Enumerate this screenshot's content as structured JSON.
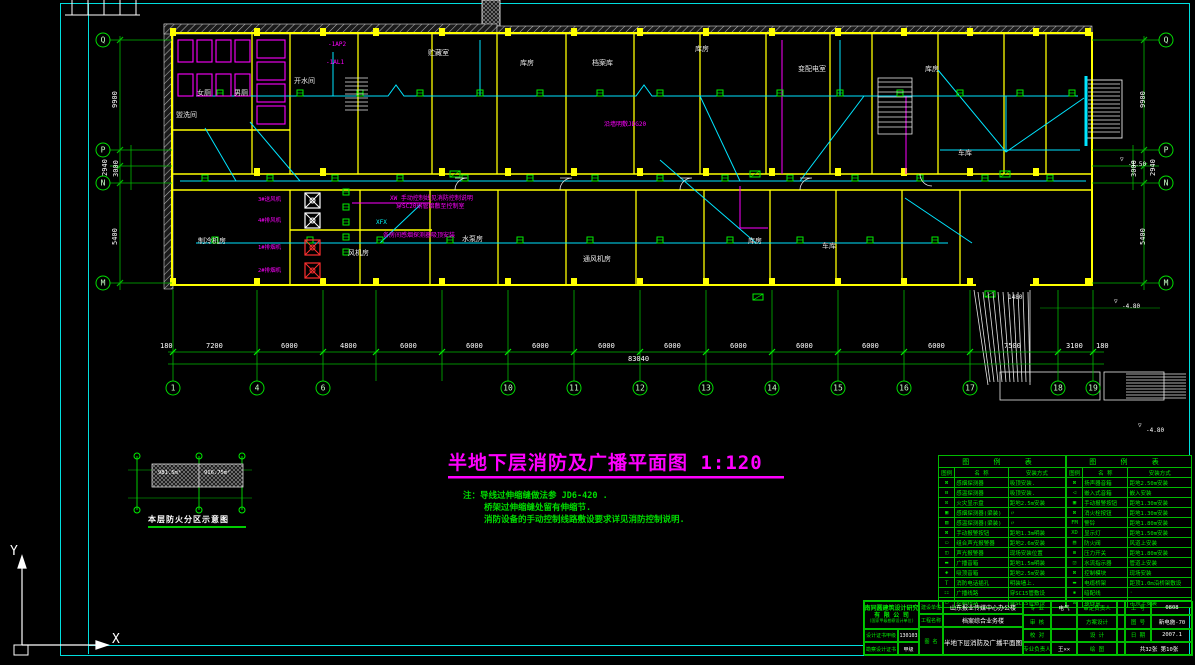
{
  "title": {
    "text": "半地下层消防及广播平面图 1:120"
  },
  "notes": {
    "prefix": "注：",
    "lines": [
      "导线过伸缩缝做法参 JD6-420 .",
      "桥架过伸缩缝处留有伸缩节.",
      "消防设备的手动控制线路敷设要求详见消防控制说明."
    ]
  },
  "compartment": {
    "caption": "本层防火分区示意图",
    "area_left": "981.5m²",
    "area_right": "916.75m²"
  },
  "ucs": {
    "x": "X",
    "y": "Y"
  },
  "grid": {
    "bottom": [
      {
        "n": "1",
        "x": 173
      },
      {
        "n": "4",
        "x": 257
      },
      {
        "n": "6",
        "x": 323
      },
      {
        "n": "10",
        "x": 508
      },
      {
        "n": "11",
        "x": 574
      },
      {
        "n": "12",
        "x": 640
      },
      {
        "n": "13",
        "x": 706
      },
      {
        "n": "14",
        "x": 772
      },
      {
        "n": "15",
        "x": 838
      },
      {
        "n": "16",
        "x": 904
      },
      {
        "n": "17",
        "x": 970
      },
      {
        "n": "18",
        "x": 1058
      },
      {
        "n": "19",
        "x": 1093
      }
    ],
    "left": [
      {
        "n": "Q",
        "y": 40
      },
      {
        "n": "P",
        "y": 150
      },
      {
        "n": "N",
        "y": 183
      },
      {
        "n": "M",
        "y": 283
      }
    ],
    "right": [
      {
        "n": "Q",
        "y": 40
      },
      {
        "n": "P",
        "y": 150
      },
      {
        "n": "N",
        "y": 183
      },
      {
        "n": "M",
        "y": 283
      }
    ]
  },
  "dims": {
    "h": [
      {
        "t": "180",
        "x": 160
      },
      {
        "t": "7200",
        "x": 206
      },
      {
        "t": "6000",
        "x": 281
      },
      {
        "t": "4800",
        "x": 340
      },
      {
        "t": "6000",
        "x": 400
      },
      {
        "t": "6000",
        "x": 466
      },
      {
        "t": "6000",
        "x": 532
      },
      {
        "t": "6000",
        "x": 598
      },
      {
        "t": "6000",
        "x": 664
      },
      {
        "t": "6000",
        "x": 730
      },
      {
        "t": "6000",
        "x": 796
      },
      {
        "t": "6000",
        "x": 862
      },
      {
        "t": "6000",
        "x": 928
      },
      {
        "t": "7500",
        "x": 1004
      },
      {
        "t": "3100",
        "x": 1066
      },
      {
        "t": "180",
        "x": 1096
      }
    ],
    "total": {
      "t": "83040",
      "x": 628
    },
    "v_left": [
      {
        "t": "9900",
        "x": 112,
        "y": 108
      },
      {
        "t": "2940",
        "x": 102,
        "y": 176
      },
      {
        "t": "3000",
        "x": 113,
        "y": 177
      },
      {
        "t": "5400",
        "x": 112,
        "y": 245
      }
    ],
    "v_right": [
      {
        "t": "9900",
        "x": 1140,
        "y": 108
      },
      {
        "t": "2940",
        "x": 1150,
        "y": 176
      },
      {
        "t": "3000",
        "x": 1131,
        "y": 177
      },
      {
        "t": "5400",
        "x": 1140,
        "y": 245
      }
    ]
  },
  "labels": {
    "rooms": [
      {
        "t": "女厕",
        "x": 197,
        "y": 90
      },
      {
        "t": "男厕",
        "x": 234,
        "y": 90
      },
      {
        "t": "开水间",
        "x": 294,
        "y": 78
      },
      {
        "t": "盥洗间",
        "x": 176,
        "y": 112
      },
      {
        "t": "贮藏室",
        "x": 428,
        "y": 50
      },
      {
        "t": "库房",
        "x": 520,
        "y": 60
      },
      {
        "t": "档案库",
        "x": 592,
        "y": 60
      },
      {
        "t": "库房",
        "x": 695,
        "y": 46
      },
      {
        "t": "变配电室",
        "x": 798,
        "y": 66
      },
      {
        "t": "库房",
        "x": 925,
        "y": 66
      },
      {
        "t": "车库",
        "x": 958,
        "y": 150
      },
      {
        "t": "制冷机房",
        "x": 198,
        "y": 238
      },
      {
        "t": "风机房",
        "x": 348,
        "y": 250
      },
      {
        "t": "水泵房",
        "x": 462,
        "y": 236
      },
      {
        "t": "通风机房",
        "x": 583,
        "y": 256
      },
      {
        "t": "库房",
        "x": 748,
        "y": 238
      },
      {
        "t": "车库",
        "x": 822,
        "y": 243
      }
    ],
    "magenta": [
      {
        "t": "-1AP2",
        "x": 328,
        "y": 42
      },
      {
        "t": "-1AL1",
        "x": 326,
        "y": 60
      },
      {
        "t": "XW 手动控制线见消防控制说明",
        "x": 390,
        "y": 196
      },
      {
        "t": "穿SC20钢管暗敷至控制室",
        "x": 396,
        "y": 204
      },
      {
        "t": "各房间感烟探测器吸顶安装",
        "x": 383,
        "y": 233
      },
      {
        "t": "沿墙明敷JDG20",
        "x": 604,
        "y": 122
      }
    ],
    "cyan": [
      {
        "t": "XFX",
        "x": 376,
        "y": 220
      }
    ],
    "white": [
      {
        "t": "▽",
        "x": 1120,
        "y": 157
      },
      {
        "t": "-1.50",
        "x": 1128,
        "y": 162
      },
      {
        "t": "▽",
        "x": 1114,
        "y": 299
      },
      {
        "t": "-4.80",
        "x": 1122,
        "y": 304
      },
      {
        "t": "▽",
        "x": 1138,
        "y": 423
      },
      {
        "t": "-4.80",
        "x": 1146,
        "y": 428
      },
      {
        "t": "1480",
        "x": 1008,
        "y": 295
      }
    ],
    "fans": [
      {
        "t": "3#送风机",
        "x": 258,
        "y": 198
      },
      {
        "t": "4#排风机",
        "x": 258,
        "y": 219
      },
      {
        "t": "1#排烟机",
        "x": 258,
        "y": 246
      },
      {
        "t": "2#排烟机",
        "x": 258,
        "y": 269
      }
    ]
  },
  "legend_left": {
    "title": "图 例 表",
    "headers": [
      "图例",
      "名 称",
      "安装方式"
    ],
    "rows": [
      {
        "sym": "⊠",
        "name": "感烟探测器",
        "inst": "吸顶安装."
      },
      {
        "sym": "⊟",
        "name": "感温探测器",
        "inst": "吸顶安装."
      },
      {
        "sym": "⊡",
        "name": "火灾显示盘",
        "inst": "距地2.5m安装"
      },
      {
        "sym": "▣",
        "name": "感烟探测器(梁装)",
        "inst": "〃"
      },
      {
        "sym": "▥",
        "name": "感温探测器(梁装)",
        "inst": "〃"
      },
      {
        "sym": "⊠",
        "name": "手动报警按钮",
        "inst": "距地1.3m明装"
      },
      {
        "sym": "▭",
        "name": "组合声光报警器",
        "inst": "距地2.6m安装"
      },
      {
        "sym": "◫",
        "name": "声光报警器",
        "inst": "现场安装位置"
      },
      {
        "sym": "▬",
        "name": "广播音箱",
        "inst": "距地1.5m明装"
      },
      {
        "sym": "◈",
        "name": "吸顶音箱",
        "inst": "距地2.5m安装"
      },
      {
        "sym": "Ｔ",
        "name": "消防电话插孔",
        "inst": "明装墙上."
      },
      {
        "sym": "⚏",
        "name": "广播线路",
        "inst": "穿SC15管敷设"
      },
      {
        "sym": "▭",
        "name": "控制线路",
        "inst": "穿SC15管敷设"
      }
    ]
  },
  "legend_right": {
    "title": "图 例 表",
    "headers": [
      "图例",
      "名 称",
      "安装方式"
    ],
    "rows": [
      {
        "sym": "⊠",
        "name": "扬声器音箱",
        "inst": "距地2.50m安装"
      },
      {
        "sym": "◁",
        "name": "嵌入式音箱",
        "inst": "嵌入安装"
      },
      {
        "sym": "▣",
        "name": "手动报警按钮",
        "inst": "距地1.30m安装"
      },
      {
        "sym": "⊠",
        "name": "消火栓按钮",
        "inst": "距地1.30m安装"
      },
      {
        "sym": "FM",
        "name": "警铃",
        "inst": "距地1.80m安装"
      },
      {
        "sym": "XD",
        "name": "显示灯",
        "inst": "距地1.50m安装"
      },
      {
        "sym": "▤",
        "name": "防火阀",
        "inst": "风道上安装"
      },
      {
        "sym": "⊞",
        "name": "压力开关",
        "inst": "距地1.80m安装"
      },
      {
        "sym": "◲",
        "name": "水流指示器",
        "inst": "管道上安装"
      },
      {
        "sym": "⊠",
        "name": "控制模块",
        "inst": "现场安装"
      },
      {
        "sym": "▬",
        "name": "电缆桥架",
        "inst": "距顶1.0m沿桥架敷设"
      },
      {
        "sym": "▪",
        "name": "暗配线",
        "inst": "·"
      },
      {
        "sym": "⊡",
        "name": "接线盒",
        "inst": "吊顶上安装"
      }
    ]
  },
  "titleblock": {
    "company": [
      "济南同圆建筑设计研究院",
      "有 限 公 司",
      "(国家甲级勘察设计单位)"
    ],
    "cert_rows": [
      [
        "设计证书甲级",
        "130103"
      ],
      [
        "勘察设计证书",
        "甲级"
      ]
    ],
    "left_labels": [
      "建设单位",
      "工程名称",
      "图 名"
    ],
    "project": "山东报业传媒中心办公楼",
    "subproject": "档案综合业务楼",
    "drawing_name": "半地下层消防及广播平面图",
    "grid_rows": [
      [
        "专 业",
        "电气",
        "审定负责人",
        "",
        "工 号",
        "0808"
      ],
      [
        "审 核",
        "",
        "方案设计",
        "",
        "图 号",
        "新电施-70"
      ],
      [
        "校 对",
        "",
        "设 计",
        "",
        "日 期",
        "2007.1"
      ],
      [
        "专业负责人",
        "王××",
        "绘 图",
        "",
        "共32张 第10张"
      ]
    ]
  }
}
